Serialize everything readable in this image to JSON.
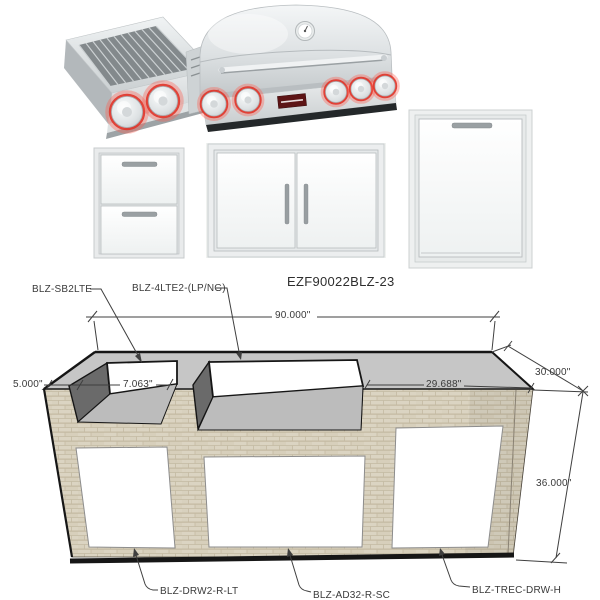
{
  "title": "EZF90022BLZ-23",
  "parts": {
    "side_burner": "BLZ-SB2LTE",
    "grill": "BLZ-4LTE2-(LP/NG)",
    "double_drawer": "BLZ-DRW2-R-LT",
    "double_door": "BLZ-AD32-R-SC",
    "trash_drawer": "BLZ-TREC-DRW-H"
  },
  "dimensions": {
    "overall_width": "90.000\"",
    "left_end_inset": "5.000\"",
    "burner_cutout": "7.063\"",
    "right_counter": "29.688\"",
    "overall_depth": "30.000\"",
    "overall_height": "36.000\""
  },
  "colors": {
    "countertop": "#c6c6c6",
    "masonry": "#dbd4c2",
    "cavity_wall": "#6a6a6a",
    "cavity_floor": "#bcbcbc",
    "stainless": "#dfe3e4",
    "knob_led_red": "#e03429",
    "line": "#3f3f3f"
  }
}
